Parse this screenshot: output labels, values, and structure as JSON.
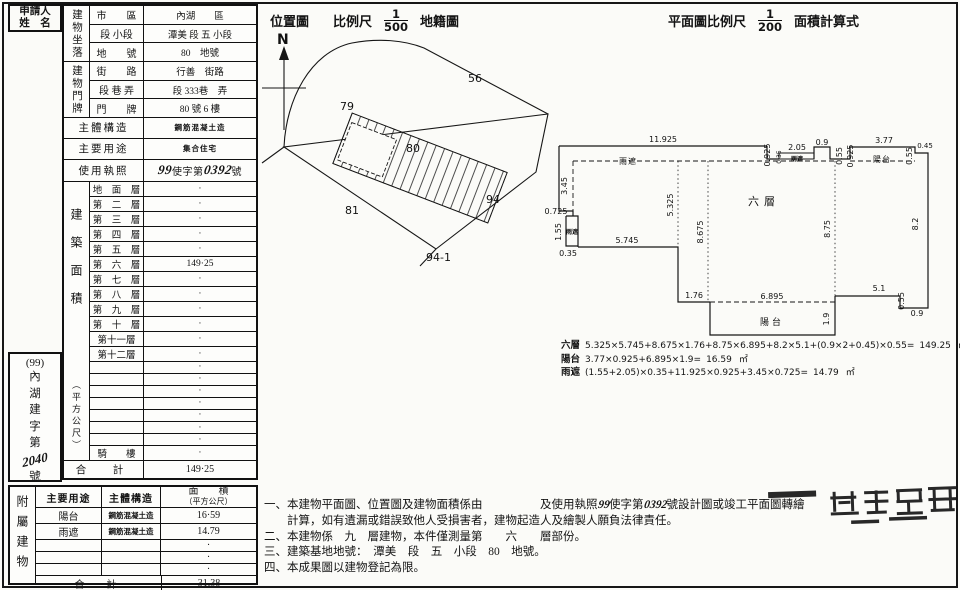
{
  "applicant": {
    "line1": "申請人",
    "line2": "姓　名"
  },
  "building_table": {
    "location_group": "建物坐落",
    "door_group": "建物門牌",
    "location_rows": [
      {
        "label": "市　　區",
        "value": "內湖　　區"
      },
      {
        "label": "段 小段",
        "value": "潭美 段 五 小段"
      },
      {
        "label": "地　　號",
        "value": "80　地號"
      },
      {
        "label": "街　　路",
        "value": "行善　街路"
      },
      {
        "label": "段 巷 弄",
        "value": "段 333巷　弄"
      },
      {
        "label": "門　　牌",
        "value": "80 號 6 樓"
      }
    ],
    "structure_label": "主體構造",
    "structure_value": "鋼筋混凝土造",
    "usage_label": "主要用途",
    "usage_value": "集合住宅",
    "license_label": "使用執照",
    "license": {
      "num1": "99",
      "mid": "使字第",
      "num2": "0392",
      "suffix": "號"
    },
    "area_label": "建築面積",
    "area_unit": "（平方公尺）",
    "floors": [
      {
        "label": "地　面　層",
        "value": "·"
      },
      {
        "label": "第　二　層",
        "value": "·"
      },
      {
        "label": "第　三　層",
        "value": "·"
      },
      {
        "label": "第　四　層",
        "value": "·"
      },
      {
        "label": "第　五　層",
        "value": "·"
      },
      {
        "label": "第　六　層",
        "value": "149·25"
      },
      {
        "label": "第　七　層",
        "value": "·"
      },
      {
        "label": "第　八　層",
        "value": "·"
      },
      {
        "label": "第　九　層",
        "value": "·"
      },
      {
        "label": "第　十　層",
        "value": "·"
      },
      {
        "label": "第十一層",
        "value": "·"
      },
      {
        "label": "第十二層",
        "value": "·"
      },
      {
        "label": "",
        "value": "·"
      },
      {
        "label": "",
        "value": "·"
      },
      {
        "label": "",
        "value": "·"
      },
      {
        "label": "",
        "value": "·"
      },
      {
        "label": "",
        "value": "·"
      },
      {
        "label": "",
        "value": "·"
      },
      {
        "label": "",
        "value": "·"
      },
      {
        "label": "騎　　樓",
        "value": "·"
      }
    ],
    "total_label": "合　計",
    "total_value": "149·25"
  },
  "case_number": {
    "top": "(99)",
    "body": "內湖建字第",
    "num": "2040",
    "suffix": "號"
  },
  "annex_table": {
    "side_label": "附屬建物",
    "h_usage": "主要用途",
    "h_structure": "主體構造",
    "h_area1": "面　　積",
    "h_area2": "（平方公尺）",
    "rows": [
      {
        "usage": "陽台",
        "structure": "鋼筋混凝土造",
        "area": "16·59"
      },
      {
        "usage": "雨遮",
        "structure": "鋼筋混凝土造",
        "area": "14.79"
      },
      {
        "usage": "",
        "structure": "",
        "area": "·"
      },
      {
        "usage": "",
        "structure": "",
        "area": "·"
      },
      {
        "usage": "",
        "structure": "",
        "area": "·"
      }
    ],
    "total_label": "合　計",
    "total_value": "31.38"
  },
  "location_map": {
    "title": "位置圖",
    "scale_label": "比例尺",
    "scale_num": "1",
    "scale_den": "500",
    "suffix": "地籍圖",
    "labels": [
      {
        "t": "N",
        "x": 277,
        "y": 44,
        "c": "map-n"
      },
      {
        "t": "79",
        "x": 340,
        "y": 110
      },
      {
        "t": "56",
        "x": 468,
        "y": 82
      },
      {
        "t": "80",
        "x": 406,
        "y": 152
      },
      {
        "t": "81",
        "x": 345,
        "y": 214
      },
      {
        "t": "94",
        "x": 486,
        "y": 203
      },
      {
        "t": "94-1",
        "x": 426,
        "y": 261
      }
    ]
  },
  "floor_plan": {
    "title_prefix": "平面圖比例尺",
    "scale_num": "1",
    "scale_den": "200",
    "title_suffix": "面積計算式",
    "dims": [
      {
        "t": "11.925",
        "x": 663,
        "y": 142
      },
      {
        "t": "雨遮",
        "x": 628,
        "y": 164,
        "c": "dim-cn"
      },
      {
        "t": "3.45",
        "x": 567,
        "y": 186,
        "r": -90
      },
      {
        "t": "0.725",
        "x": 556,
        "y": 214
      },
      {
        "t": "1.55",
        "x": 561,
        "y": 232,
        "r": -90
      },
      {
        "t": "雨遮",
        "x": 572,
        "y": 234,
        "c": "dim-cn-sm"
      },
      {
        "t": "0.35",
        "x": 568,
        "y": 256
      },
      {
        "t": "5.745",
        "x": 627,
        "y": 243
      },
      {
        "t": "5.325",
        "x": 673,
        "y": 205,
        "r": -90
      },
      {
        "t": "8.675",
        "x": 703,
        "y": 232,
        "r": -90
      },
      {
        "t": "1.76",
        "x": 694,
        "y": 298
      },
      {
        "t": "6.895",
        "x": 772,
        "y": 299
      },
      {
        "t": "陽台",
        "x": 772,
        "y": 325,
        "c": "dim-cn-md"
      },
      {
        "t": "1.9",
        "x": 829,
        "y": 319,
        "r": -90
      },
      {
        "t": "5.1",
        "x": 879,
        "y": 291
      },
      {
        "t": "0.55",
        "x": 904,
        "y": 301,
        "r": -90
      },
      {
        "t": "0.9",
        "x": 917,
        "y": 316
      },
      {
        "t": "8.2",
        "x": 918,
        "y": 224,
        "r": -90
      },
      {
        "t": "8.75",
        "x": 830,
        "y": 229,
        "r": -90
      },
      {
        "t": "六層",
        "x": 764,
        "y": 205,
        "c": "dim-cn-lg"
      },
      {
        "t": "0.925",
        "x": 770,
        "y": 155,
        "r": -90
      },
      {
        "t": "0.35",
        "x": 781,
        "y": 157,
        "r": -90,
        "c": "dim-s"
      },
      {
        "t": "2.05",
        "x": 797,
        "y": 150
      },
      {
        "t": "雨遮",
        "x": 797,
        "y": 161,
        "c": "dim-cn-sm"
      },
      {
        "t": "0.9",
        "x": 822,
        "y": 145
      },
      {
        "t": "0.55",
        "x": 842,
        "y": 156,
        "r": -90
      },
      {
        "t": "0.925",
        "x": 853,
        "y": 156,
        "r": -90
      },
      {
        "t": "3.77",
        "x": 884,
        "y": 143
      },
      {
        "t": "陽台",
        "x": 882,
        "y": 162,
        "c": "dim-cn"
      },
      {
        "t": "0.55",
        "x": 912,
        "y": 156,
        "r": -90
      },
      {
        "t": "0.45",
        "x": 925,
        "y": 148,
        "c": "dim-s2"
      }
    ],
    "formulas": [
      {
        "name": "六層",
        "expr": "5.325×5.745+8.675×1.76+8.75×6.895+8.2×5.1+(0.9×2+0.45)×0.55=",
        "result": "149.25",
        "unit": "㎡"
      },
      {
        "name": "陽台",
        "expr": "3.77×0.925+6.895×1.9=",
        "result": "16.59",
        "unit": "㎡"
      },
      {
        "name": "雨遮",
        "expr": "(1.55+2.05)×0.35+11.925×0.925+3.45×0.725=",
        "result": "14.79",
        "unit": "㎡"
      }
    ]
  },
  "notes": {
    "line1_pre": "一、本建物平面圖、位置圖及建物面積係由　　　　　及使用執照",
    "line1_num1": "99",
    "line1_mid": "使字第",
    "line1_num2": "0392",
    "line1_end": "號設計圖或竣工平面圖轉繪",
    "line2": "　　計算，如有遺漏或錯誤致他人受損害者，建物起造人及繪製人願負法律責任。",
    "line3": "二、本建物係　九　層建物，本件僅測量第　　六　　層部份。",
    "line4": "三、建築基地地號：　潭美　段　五　小段　80　地號。",
    "line5": "四、本成果圖以建物登記為限。"
  }
}
